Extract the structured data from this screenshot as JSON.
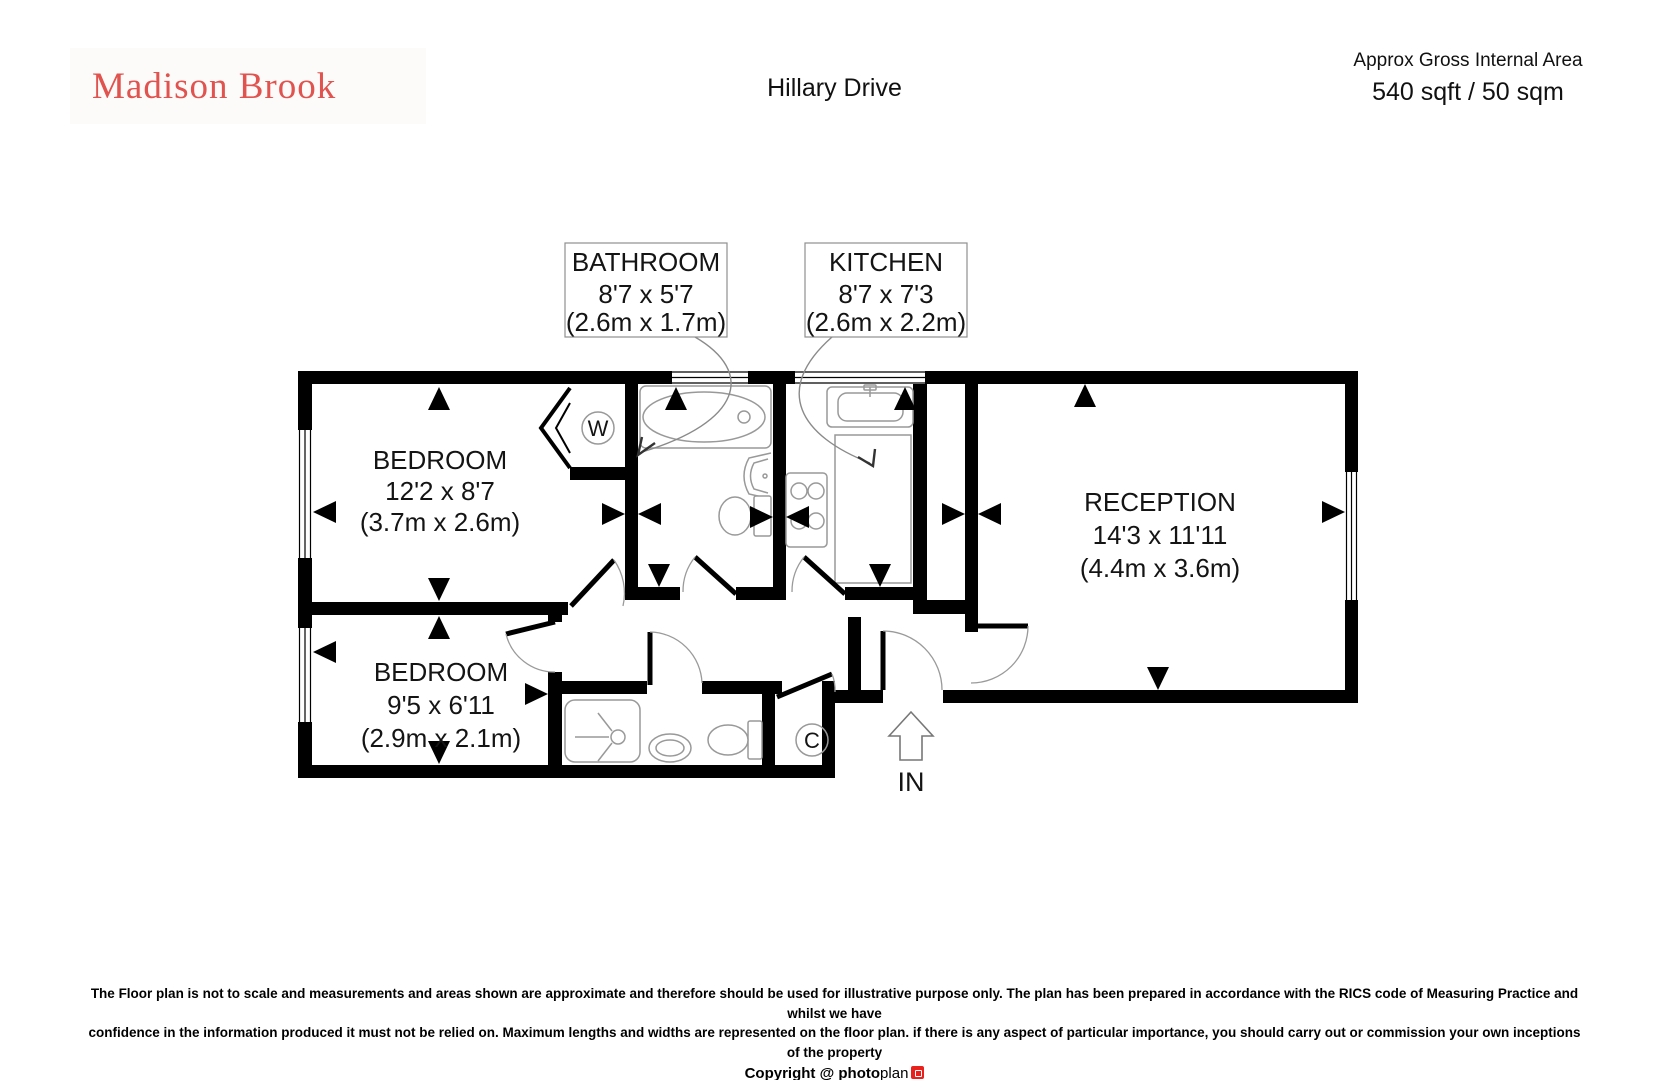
{
  "header": {
    "logo": "Madison Brook",
    "title": "Hillary Drive",
    "area_label": "Approx Gross Internal Area",
    "area_value": "540 sqft / 50 sqm"
  },
  "plan": {
    "rooms": [
      {
        "name": "BATHROOM",
        "imperial": "8'7 x 5'7",
        "metric": "(2.6m x 1.7m)"
      },
      {
        "name": "KITCHEN",
        "imperial": "8'7 x 7'3",
        "metric": "(2.6m x 2.2m)"
      },
      {
        "name": "BEDROOM",
        "imperial": "12'2 x 8'7",
        "metric": "(3.7m x 2.6m)"
      },
      {
        "name": "RECEPTION",
        "imperial": "14'3 x 11'11",
        "metric": "(4.4m x 3.6m)"
      },
      {
        "name": "BEDROOM",
        "imperial": "9'5 x 6'11",
        "metric": "(2.9m x 2.1m)"
      }
    ],
    "annotations": {
      "wardrobe": "W",
      "cupboard": "C",
      "entrance": "IN"
    }
  },
  "footer": {
    "disclaimer1": "The Floor plan is not to scale and measurements and areas shown are approximate and therefore should be used for illustrative purpose only. The plan has been prepared in accordance with the RICS code of Measuring Practice and whilst we have",
    "disclaimer2": "confidence in the information produced it must not be relied on. Maximum lengths and widths are represented on the floor plan. if there is any aspect of particular importance, you should carry out or commission your own inceptions of the property",
    "copyright": "Copyright @ ",
    "brand_bold": "photo",
    "brand_regular": "plan"
  },
  "colors": {
    "logo_red": "#e0534e",
    "brand_red": "#e8211d"
  }
}
